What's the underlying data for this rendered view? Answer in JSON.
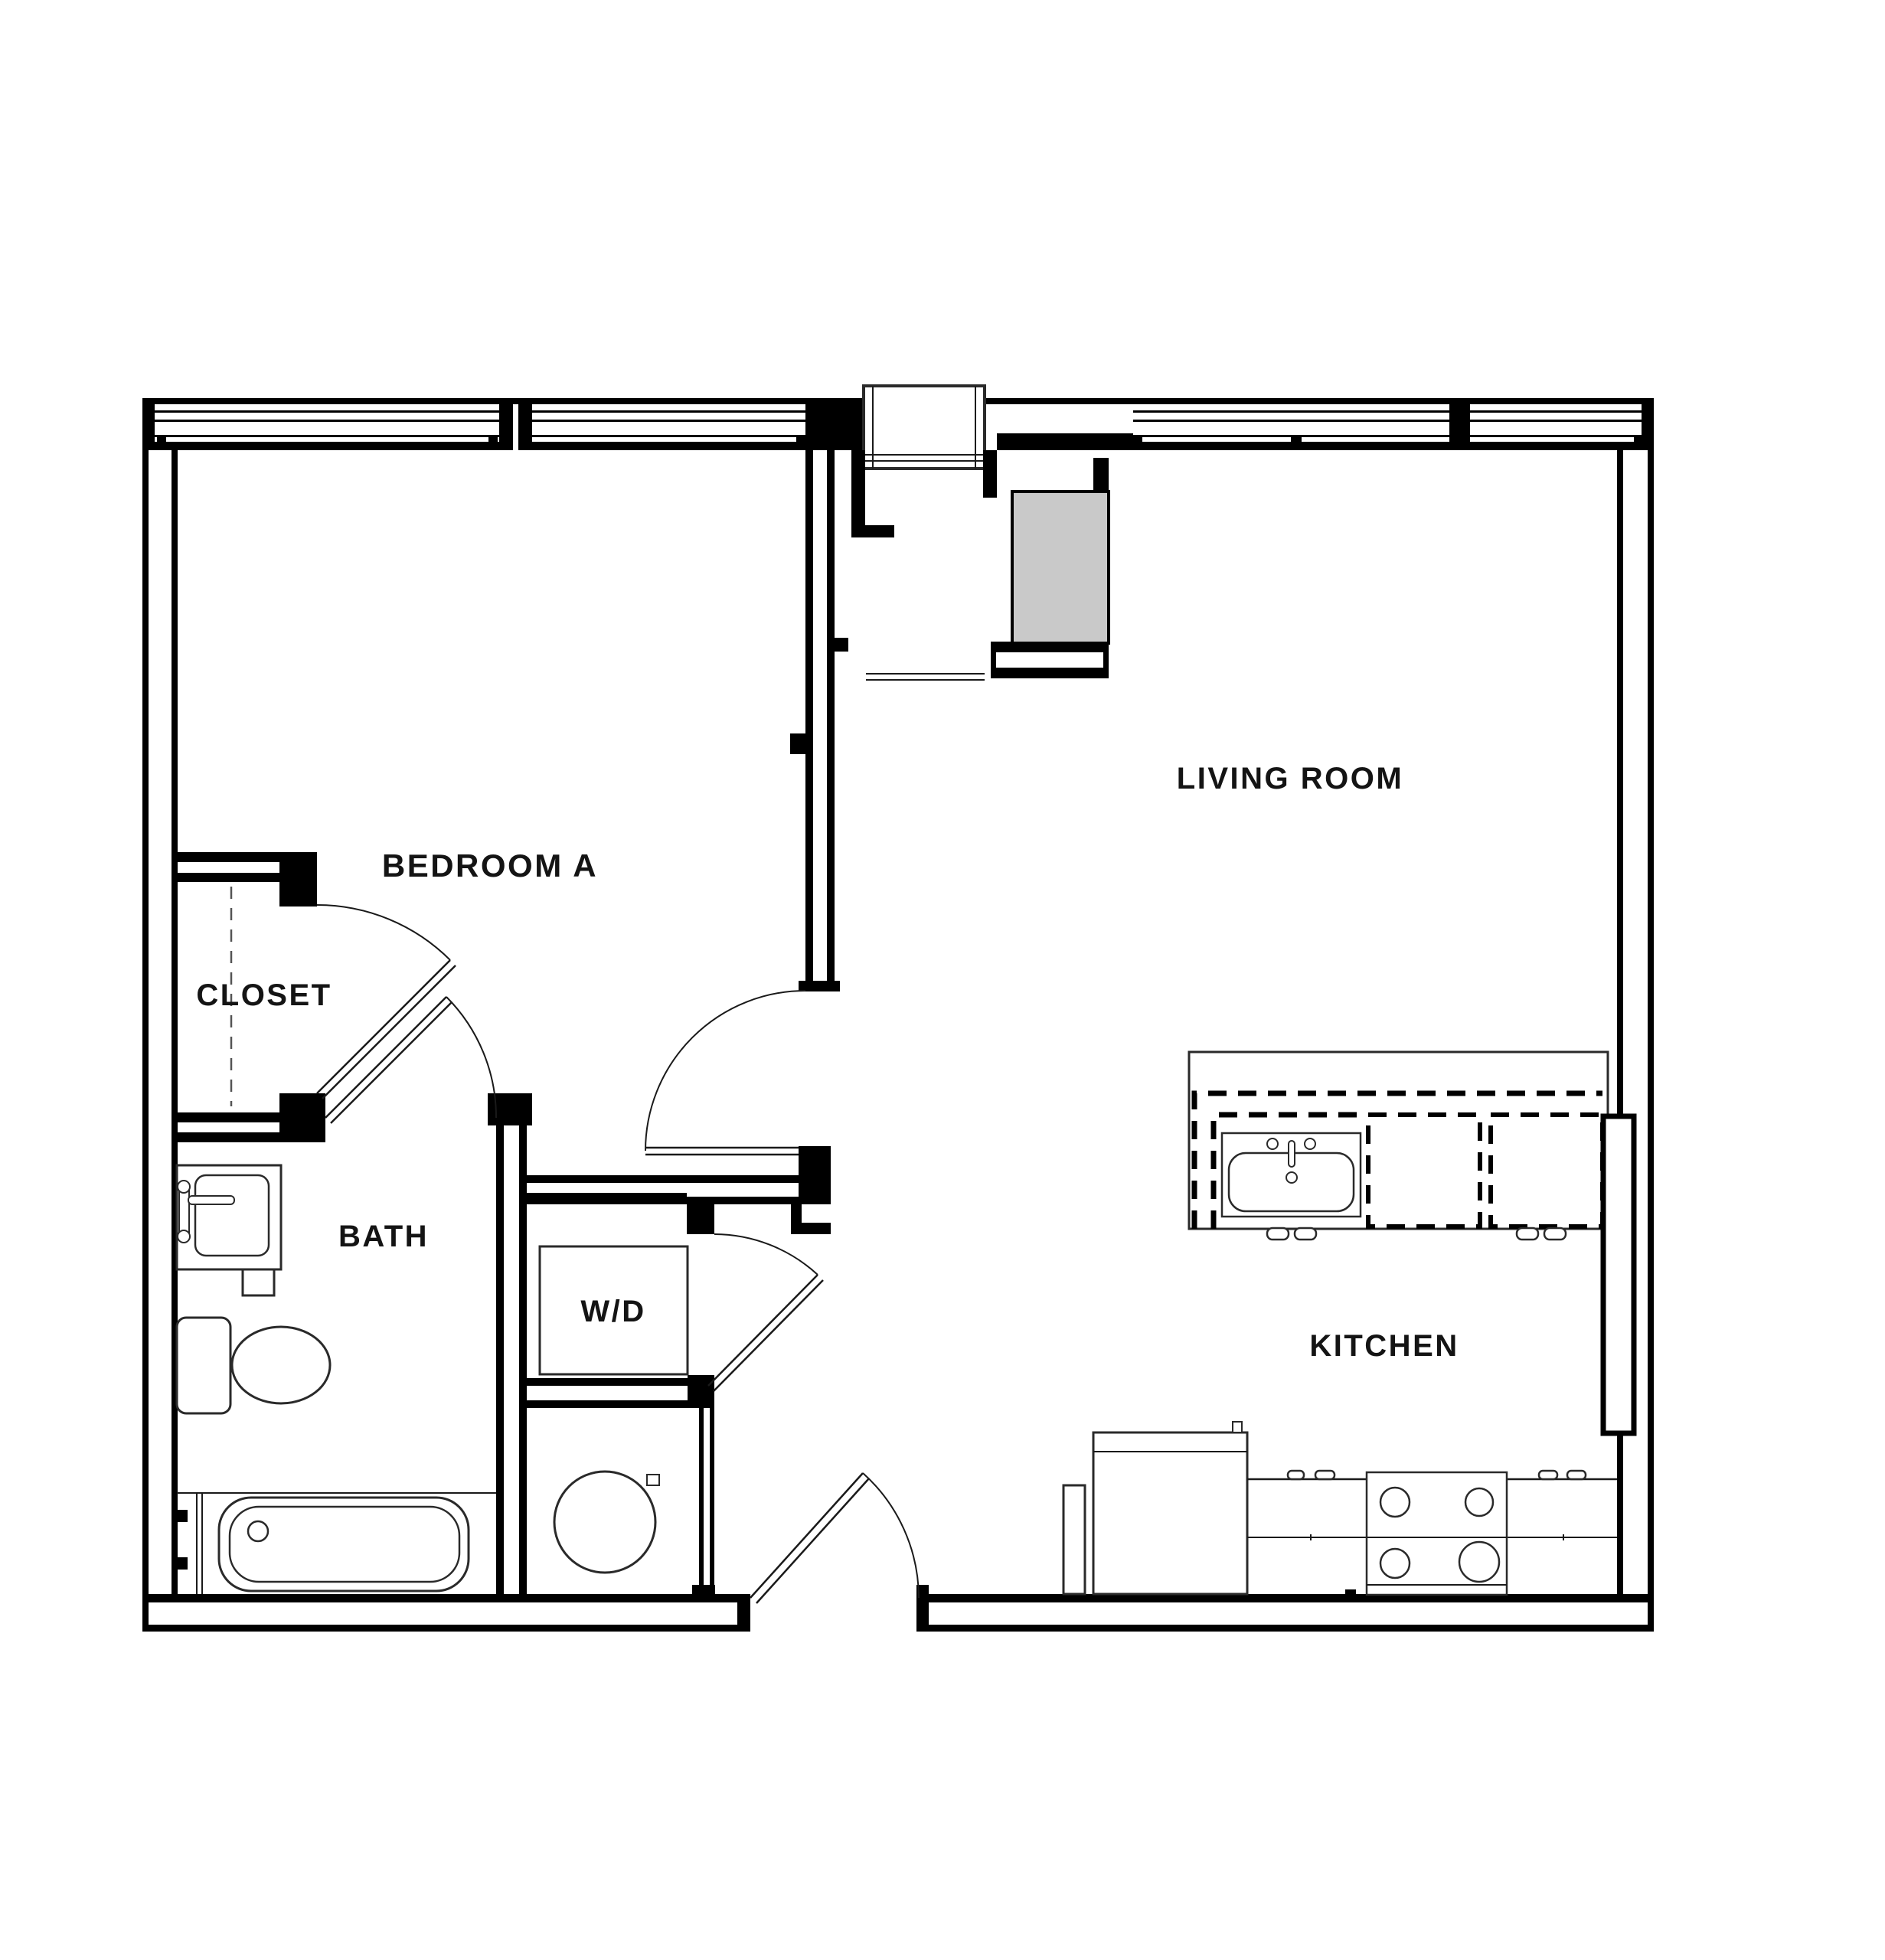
{
  "document": {
    "type": "apartment-floor-plan",
    "background": "#ffffff"
  },
  "colors": {
    "line": "#000000",
    "label_text": "#141414",
    "wall_core": "#ffffff",
    "equipment_fill": "#c9c9c9"
  },
  "floor_plan": {
    "labels": {
      "bedroom_a": "BEDROOM A",
      "living_room": "LIVING ROOM",
      "closet": "CLOSET",
      "bath": "BATH",
      "washer_dryer": "W/D",
      "kitchen": "KITCHEN"
    }
  }
}
